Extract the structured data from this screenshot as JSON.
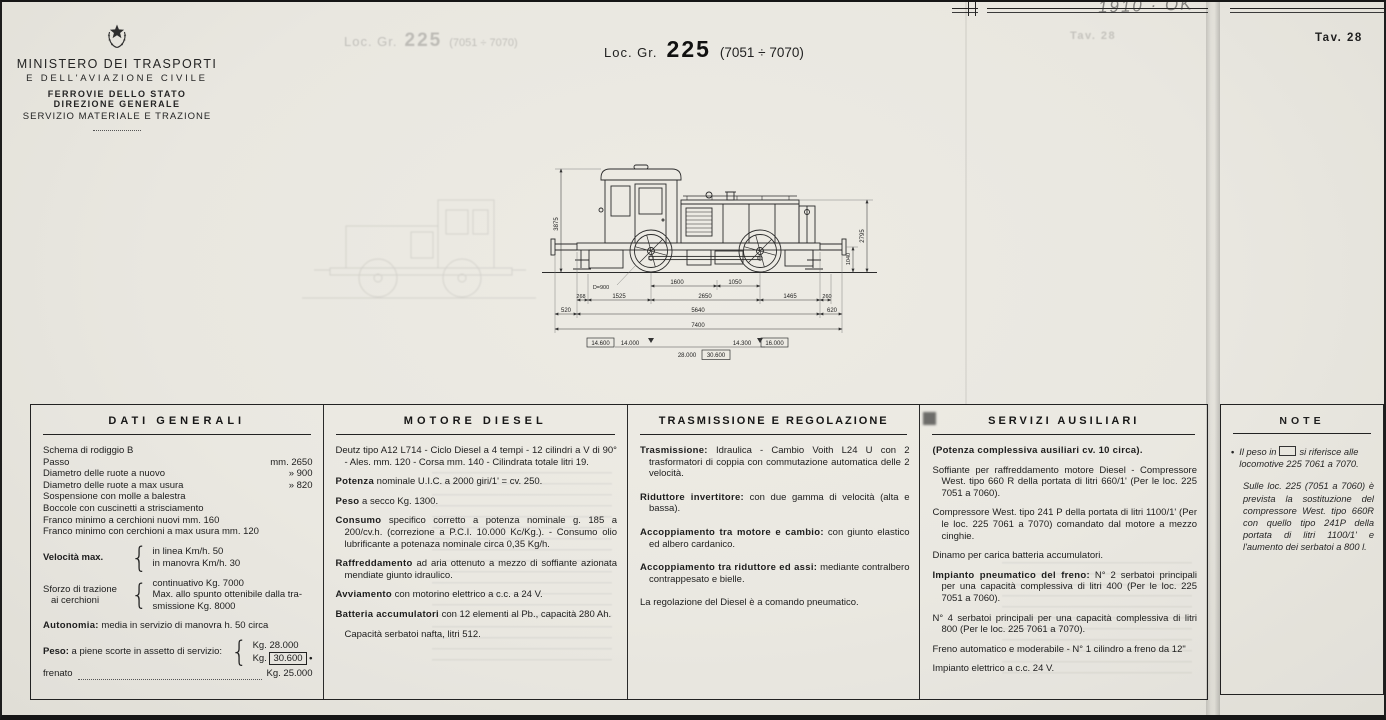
{
  "page": {
    "tav": "Tav. 28",
    "tav_ghost": "Tav. 28",
    "handwritten_note": "1910 · OK"
  },
  "ministry": {
    "line1": "MINISTERO DEI TRASPORTI",
    "line2": "E DELL'AVIAZIONE CIVILE",
    "line3": "FERROVIE DELLO STATO",
    "line4": "DIREZIONE GENERALE",
    "line5": "SERVIZIO MATERIALE E TRAZIONE"
  },
  "title": {
    "prefix": "Loc. Gr.",
    "number": "225",
    "range": "(7051 ÷ 7070)"
  },
  "drawing": {
    "dims": {
      "height_total": "3875",
      "height_hood": "2795",
      "buffer_height": "1040",
      "wheel_dia": "D=900",
      "d1600": "1600",
      "d1050": "1050",
      "d268": "268",
      "d1525": "1525",
      "d2650": "2650",
      "d1465": "1465",
      "d260": "260",
      "d520": "520",
      "d5640": "5640",
      "d620": "620",
      "d7400": "7400",
      "w1_box": "14.600",
      "w1": "14.000",
      "w2": "14.300",
      "w2_box": "16.000",
      "wtot": "28.000",
      "wtot_box": "30.600"
    }
  },
  "table": {
    "dati": {
      "title": "DATI GENERALI",
      "schema": "Schema di rodiggio B",
      "rows": [
        {
          "label": "Passo",
          "value": "mm.  2650"
        },
        {
          "label": "Diametro delle ruote a nuovo",
          "value": "»    900"
        },
        {
          "label": "Diametro delle ruote a max usura",
          "value": "»    820"
        }
      ],
      "lines": [
        "Sospensione con molle a balestra",
        "Boccole con cuscinetti a strisciamento",
        "Franco minimo a cerchioni nuovi mm. 160",
        "Franco minimo con cerchioni a max usura mm. 120"
      ],
      "velocita": {
        "label": "Velocità max.",
        "item1": "in linea Km/h. 50",
        "item2": "in manovra Km/h. 30"
      },
      "sforzo": {
        "label1": "Sforzo di trazione",
        "label2": "ai cerchioni",
        "item1": "continuativo Kg. 7000",
        "item2": "Max. allo spunto ottenibile dalla tra-smissione Kg. 8000"
      },
      "autonomia": {
        "lead": "Autonomia:",
        "text": "media in servizio di manovra h. 50 circa"
      },
      "peso": {
        "lead": "Peso:",
        "text": "a piene scorte in assetto di servizio:",
        "v1": "Kg.  28.000",
        "v2_prefix": "Kg.",
        "v2_boxed": "30.600",
        "marker": "•"
      },
      "frenato": {
        "label": "frenato",
        "value": "Kg.  25.000"
      }
    },
    "motore": {
      "title": "MOTORE DIESEL",
      "paragraphs": [
        {
          "lead": "",
          "text": "Deutz tipo A12 L714 - Ciclo Diesel a 4 tempi - 12 cilindri a V di 90° - Ales. mm. 120 - Corsa mm. 140 - Cilindrata totale litri 19."
        },
        {
          "lead": "Potenza",
          "text": "nominale U.I.C. a 2000 giri/1' = cv. 250."
        },
        {
          "lead": "Peso",
          "text": "a secco Kg. 1300."
        },
        {
          "lead": "Consumo",
          "text": "specifico corretto a potenza nominale g. 185 a 200/cv.h. (correzione a P.C.I. 10.000 Kc/Kg.). - Consumo olio lubrificante a potenaza nominale circa 0,35 Kg/h."
        },
        {
          "lead": "Raffreddamento",
          "text": "ad aria ottenuto a mezzo di soffiante azionata mendiate giunto idraulico."
        },
        {
          "lead": "Avviamento",
          "text": "con motorino elettrico a c.c. a 24 V."
        },
        {
          "lead": "Batteria accumulatori",
          "text": "con 12 elementi al Pb., capacità 280 Ah."
        },
        {
          "lead": "",
          "text": "Capacità serbatoi nafta, litri 512."
        }
      ]
    },
    "trasmissione": {
      "title": "TRASMISSIONE E REGOLAZIONE",
      "paragraphs": [
        {
          "lead": "Trasmissione:",
          "text": "Idraulica - Cambio Voith L24 U con 2 trasformatori di coppia con commutazione automatica delle 2 velocità."
        },
        {
          "lead": "Riduttore invertitore:",
          "text": "con due gamma di velocità (alta e bassa)."
        },
        {
          "lead": "Accoppiamento tra motore e cambio:",
          "text": "con giunto elastico ed albero cardanico."
        },
        {
          "lead": "Accoppiamento tra riduttore ed assi:",
          "text": "mediante contralbero contrappesato e bielle."
        },
        {
          "lead": "",
          "text": "La regolazione del Diesel è a comando pneumatico."
        }
      ]
    },
    "servizi": {
      "title": "SERVIZI AUSILIARI",
      "paragraphs": [
        {
          "lead": "(Potenza complessiva ausiliari cv. 10 circa).",
          "text": ""
        },
        {
          "lead": "",
          "text": "Soffiante per raffreddamento motore Diesel - Compressore West. tipo 660 R della portata di litri 660/1' (Per le loc. 225 7051 a 7060)."
        },
        {
          "lead": "",
          "text": "Compressore West. tipo 241 P della portata di litri 1100/1' (Per le loc. 225 7061 a 7070) comandato dal motore a mezzo cinghie."
        },
        {
          "lead": "",
          "text": "Dinamo per carica batteria accumulatori."
        },
        {
          "lead": "Impianto pneumatico del freno:",
          "text": "N° 2 serbatoi principali per una capacità complessiva di litri 400 (Per le loc. 225 7051 a 7060)."
        },
        {
          "lead": "",
          "text": "N° 4 serbatoi principali per una capacità complessiva di litri 800 (Per le loc. 225 7061 a 7070)."
        },
        {
          "lead": "",
          "text": "Freno automatico e moderabile - N° 1 cilindro a freno da 12\""
        },
        {
          "lead": "",
          "text": "Impianto elettrico a c.c. 24 V."
        }
      ]
    }
  },
  "note": {
    "title": "NOTE",
    "marker": "•",
    "p1_pre": "Il peso in",
    "p1_post": "si riferisce alle locomotive 225 7061 a 7070.",
    "p2": "Sulle loc. 225 (7051 a 7060) è prevista la sostituzione del compressore West. tipo 660R con quello tipo 241P della portata di litri 1100/1' e l'aumento dei serbatoi a 800 l."
  }
}
